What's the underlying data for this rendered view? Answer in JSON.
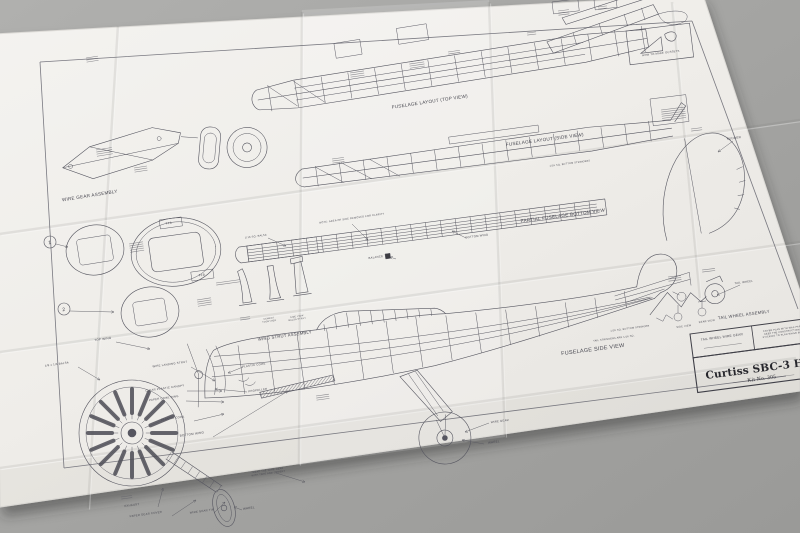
{
  "scene": {
    "description": "Photograph of a folded model aircraft plan sheet lying on a gray surface",
    "colors": {
      "background": "#a6a6a4",
      "paper": "#f2f1ed",
      "ink": "#53535c"
    }
  },
  "title_block": {
    "title": "Curtiss SBC-3 HELLDIVER",
    "kit_no": "Kit No. 305",
    "corner_cell": "TAIL WHEEL WIRE GEAR",
    "note": [
      "COVER PLAN WITH WAX PAPER TO",
      "KEEP THE CONSTRUCTION FROM",
      "STICKING TO PLAN WHILE BUILDING"
    ]
  },
  "labels": [
    {
      "id": "fuselage-layout-top-view",
      "t": "FUSELAGE LAYOUT (TOP VIEW)",
      "x": 430,
      "y": 103,
      "r": -8.5,
      "s": 4.6
    },
    {
      "id": "fuselage-layout-side-view",
      "t": "FUSELAGE LAYOUT (SIDE VIEW)",
      "x": 545,
      "y": 141,
      "r": -7.5,
      "s": 4.6
    },
    {
      "id": "partial-fuselage-bottom-view",
      "t": "PARTIAL FUSELAGE BOTTOM VIEW",
      "x": 563,
      "y": 217,
      "r": -7.5,
      "s": 4.6
    },
    {
      "id": "fuselage-side-view",
      "t": "FUSELAGE SIDE VIEW",
      "x": 593,
      "y": 351,
      "r": -7.5,
      "s": 5.5,
      "c": "wide"
    },
    {
      "id": "wire-gear-assembly",
      "t": "WIRE GEAR ASSEMBLY",
      "x": 90,
      "y": 197,
      "r": -9,
      "s": 4.6
    },
    {
      "id": "wing-strut-assembly",
      "t": "WING STRUT ASSEMBLY",
      "x": 285,
      "y": 337,
      "r": -8,
      "s": 4.2
    },
    {
      "id": "tail-wheel-assembly",
      "t": "TAIL WHEEL ASSEMBLY",
      "x": 744,
      "y": 316,
      "r": -7.5,
      "s": 4.2
    },
    {
      "id": "top-wing",
      "t": "TOP WING",
      "x": 103,
      "y": 340,
      "r": -8,
      "s": 3
    },
    {
      "id": "balsa-18x14",
      "t": "1/8 x 1/4 BALSA",
      "x": 57,
      "y": 365,
      "r": -8,
      "s": 2.8
    },
    {
      "id": "wire-landing-strut",
      "t": "WIRE LANDING STRUT",
      "x": 170,
      "y": 365,
      "r": -8,
      "s": 2.8
    },
    {
      "id": "clear-plastic-canopy",
      "t": "CLEAR PLASTIC CANOPY",
      "x": 165,
      "y": 389,
      "r": -8,
      "s": 2.8
    },
    {
      "id": "paper-cowl-ring",
      "t": "PAPER COWL RING",
      "x": 164,
      "y": 399,
      "r": -8,
      "s": 2.8
    },
    {
      "id": "plastic-cowl",
      "t": "PLASTIC COWL",
      "x": 173,
      "y": 419,
      "r": -8,
      "s": 2.8
    },
    {
      "id": "bottom-wing",
      "t": "BOTTOM WING",
      "x": 192,
      "y": 435,
      "r": -8,
      "s": 3
    },
    {
      "id": "plastic-cowl-2",
      "t": "PLASTIC COWL",
      "x": 254,
      "y": 366,
      "r": -8,
      "s": 2.8
    },
    {
      "id": "propeller",
      "t": "PROPELLER",
      "x": 258,
      "y": 391,
      "r": -8,
      "s": 2.8
    },
    {
      "id": "exhaust",
      "t": "EXHAUST",
      "x": 132,
      "y": 506,
      "r": -8,
      "s": 2.8
    },
    {
      "id": "paper-gear-cover",
      "t": "PAPER GEAR COVER",
      "x": 146,
      "y": 515,
      "r": -8,
      "s": 2.8
    },
    {
      "id": "wire-gear-tip",
      "t": "WIRE GEAR TIP",
      "x": 202,
      "y": 512,
      "r": -8,
      "s": 2.8
    },
    {
      "id": "wheel-main",
      "t": "WHEEL",
      "x": 494,
      "y": 443,
      "r": -7.5,
      "s": 3
    },
    {
      "id": "wire-gear",
      "t": "WIRE GEAR",
      "x": 500,
      "y": 422,
      "r": -7.5,
      "s": 2.8
    },
    {
      "id": "wheel-bottom",
      "t": "WHEEL",
      "x": 249,
      "y": 509,
      "r": -8,
      "s": 3
    },
    {
      "id": "bottom-wing-2",
      "t": "BOTTOM WING",
      "x": 477,
      "y": 237,
      "r": -7.5,
      "s": 2.8
    },
    {
      "id": "balance",
      "t": "BALANCE",
      "x": 376,
      "y": 258,
      "r": -8,
      "s": 2.8
    },
    {
      "id": "note-clarity",
      "t": "NOTE: AREA OF SIDE REMOVED FOR CLARITY",
      "x": 352,
      "y": 219,
      "r": -8,
      "s": 2.5
    },
    {
      "id": "sq-balsa",
      "t": "1/16 SQ. BALSA",
      "x": 256,
      "y": 237,
      "r": -8,
      "s": 2.5
    },
    {
      "id": "bottom-stringers",
      "t": "1/16 SQ. BOTTOM STRINGERS",
      "x": 570,
      "y": 164,
      "r": -7.5,
      "s": 2.4
    },
    {
      "id": "bottom-stringer-2",
      "t": "1/16 SQ. BOTTOM STRINGER",
      "x": 630,
      "y": 329,
      "r": -7.5,
      "s": 2.4
    },
    {
      "id": "tail-stringers",
      "t": "TAIL STRINGERS ARE 1/16 SQ.",
      "x": 614,
      "y": 339,
      "r": -7.5,
      "s": 2.4
    },
    {
      "id": "rudder",
      "t": "RUDDER",
      "x": 734,
      "y": 139,
      "r": -7.5,
      "s": 3
    },
    {
      "id": "tail-wheel",
      "t": "TAIL WHEEL",
      "x": 744,
      "y": 283,
      "r": -7.5,
      "s": 2.8
    },
    {
      "id": "side-view-small",
      "t": "SIDE VIEW",
      "x": 684,
      "y": 327,
      "r": -7.5,
      "s": 2.5
    },
    {
      "id": "rear-view-small",
      "t": "REAR VIEW",
      "x": 707,
      "y": 322,
      "r": -7.5,
      "s": 2.5
    },
    {
      "id": "cement-together",
      "lines": [
        "CEMENT",
        "TOGETHER"
      ],
      "x": 269,
      "y": 319,
      "r": -8,
      "s": 2.2
    },
    {
      "id": "side-view-balsa-strut",
      "lines": [
        "SIDE VIEW",
        "BALSA STRUT"
      ],
      "x": 297,
      "y": 317,
      "r": -8,
      "s": 2.2
    },
    {
      "id": "wrap-note",
      "lines": [
        "WRAP THE WIRE GEAR",
        "WITH TAPE AND CEMENT"
      ],
      "x": 268,
      "y": 471,
      "r": -8,
      "s": 2.4
    },
    {
      "id": "step-1",
      "t": "1",
      "x": 50,
      "y": 244,
      "r": -8,
      "s": 5
    },
    {
      "id": "step-2",
      "t": "2",
      "x": 64,
      "y": 311,
      "r": -8,
      "s": 5
    },
    {
      "id": "f1a",
      "t": "F1A",
      "x": 169,
      "y": 224,
      "r": -8,
      "s": 3
    },
    {
      "id": "f1b",
      "t": "F1B",
      "x": 202,
      "y": 276,
      "r": -8,
      "s": 3
    },
    {
      "id": "how-to-make-gussets",
      "t": "HOW TO MAKE GUSSETS",
      "x": 661,
      "y": 54,
      "r": -7,
      "s": 2.7
    },
    {
      "id": "plan-title",
      "t": "Curtiss SBC-3 HELLDIVER",
      "x": 706,
      "y": 379,
      "r": -7.5,
      "s": 10.5,
      "a": "s",
      "c": "ttl"
    },
    {
      "id": "kit-no",
      "t": "Kit No. 305",
      "x": 762,
      "y": 380,
      "r": -7.5,
      "s": 5.5,
      "c": "srf"
    },
    {
      "id": "tail-wheel-wire-gear",
      "t": "TAIL WHEEL WIRE GEAR",
      "x": 722,
      "y": 338,
      "r": -7.5,
      "s": 3.2
    },
    {
      "id": "wax-paper-note",
      "lines": [
        "COVER PLAN WITH WAX PAPER TO",
        "KEEP THE CONSTRUCTION FROM",
        "STICKING TO PLAN WHILE BUILDING"
      ],
      "x": 786,
      "y": 329,
      "r": -7.5,
      "s": 2.3
    }
  ]
}
